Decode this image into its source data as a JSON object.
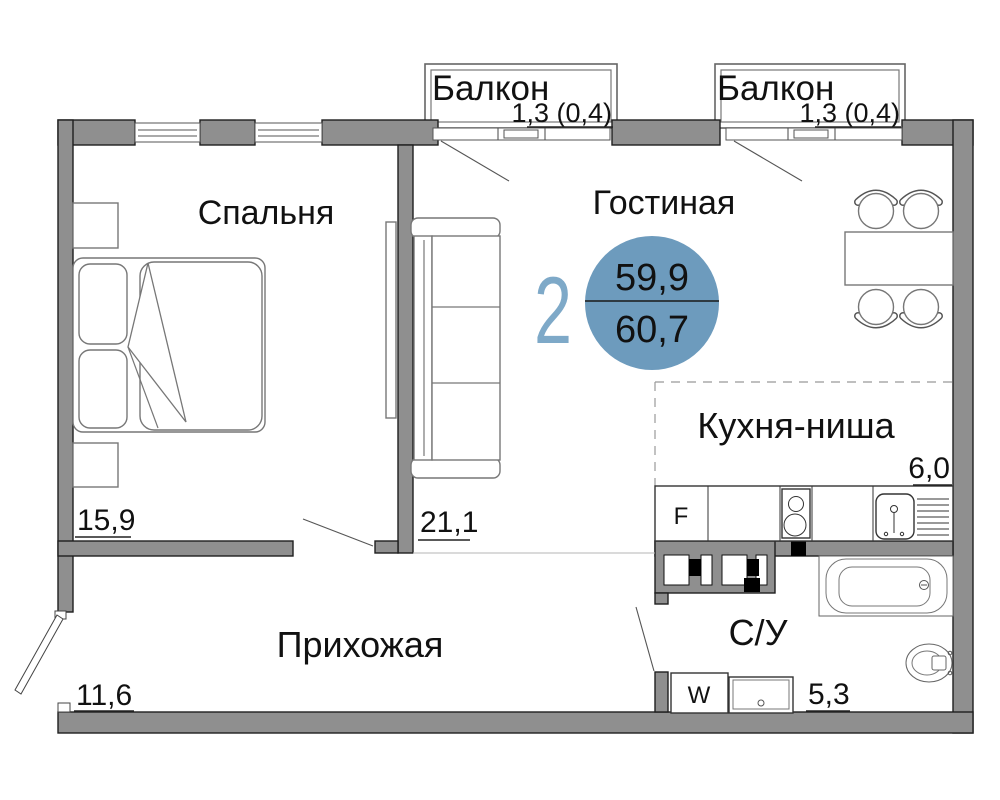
{
  "plan": {
    "badge": {
      "rooms_count": "2",
      "area_total": "59,9",
      "area_living": "60,7"
    },
    "rooms": {
      "bedroom": {
        "label": "Спальня",
        "area": "15,9"
      },
      "living": {
        "label": "Гостиная",
        "area": "21,1"
      },
      "kitchen": {
        "label": "Кухня-ниша",
        "area": "6,0"
      },
      "hallway": {
        "label": "Прихожая",
        "area": "11,6"
      },
      "bathroom": {
        "label": "С/У",
        "area": "5,3"
      },
      "balcony_left": {
        "label": "Балкон",
        "area": "1,3 (0,4)"
      },
      "balcony_right": {
        "label": "Балкон",
        "area": "1,3 (0,4)"
      }
    },
    "appliances": {
      "fridge_label": "F",
      "washer_label": "W"
    },
    "colors": {
      "wall": "#8f8f8f",
      "badge_circle": "#6d9bbd",
      "badge_number": "#7ea9c8",
      "text": "#111111"
    }
  }
}
